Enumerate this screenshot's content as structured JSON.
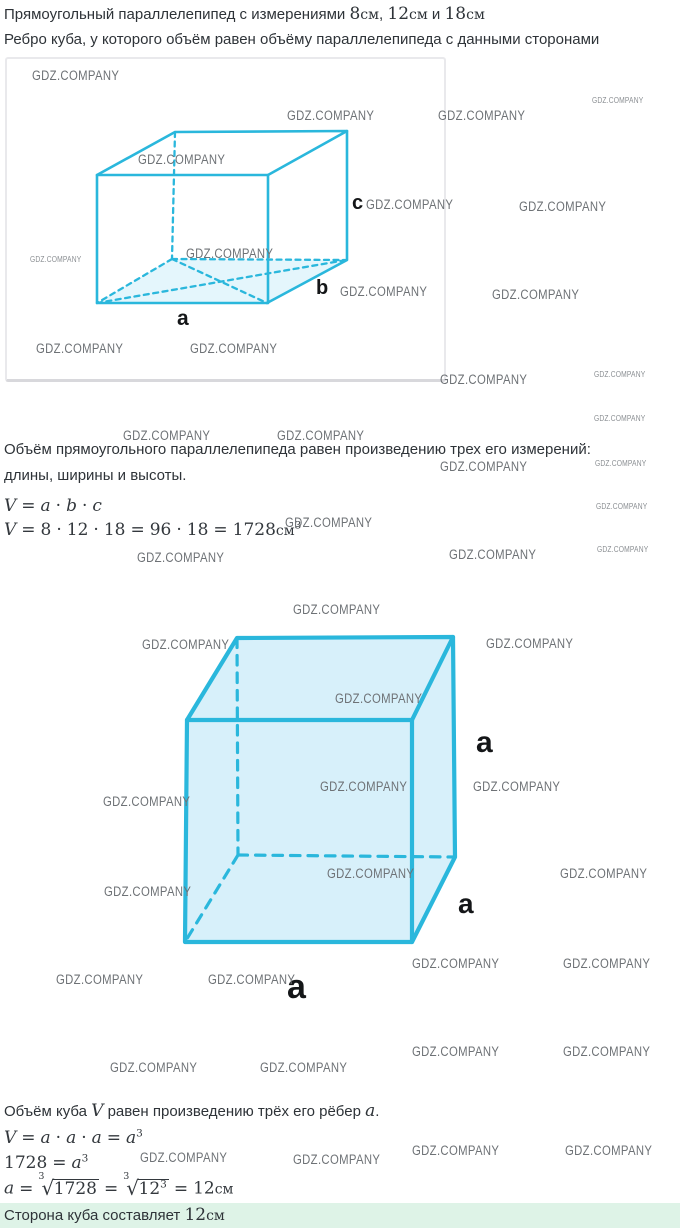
{
  "colors": {
    "accent_cyan": "#2ab7dc",
    "cube_fill": "#d7f0fa",
    "base_tint": "#e4f6fc",
    "text_dark": "#2e3338",
    "watermark_gray": "#6e7276",
    "answer_bg": "#def3e7"
  },
  "header": {
    "line1": [
      {
        "k": "t",
        "t": "Прямоугольный параллелепипед с измерениями "
      },
      {
        "k": "n",
        "t": "8"
      },
      {
        "k": "u",
        "t": "см"
      },
      {
        "k": "t",
        "t": ", "
      },
      {
        "k": "n",
        "t": "12"
      },
      {
        "k": "u",
        "t": "см"
      },
      {
        "k": "t",
        "t": " и "
      },
      {
        "k": "n",
        "t": "18"
      },
      {
        "k": "u",
        "t": "см"
      }
    ],
    "line2": "Ребро куба, у которого объём равен объёму параллелепипеда с данными сторонами"
  },
  "watermark": {
    "text": "GDZ.COMPANY",
    "items": [
      {
        "x": 32,
        "y": 68,
        "s": "r"
      },
      {
        "x": 287,
        "y": 108,
        "s": "r"
      },
      {
        "x": 438,
        "y": 108,
        "s": "r"
      },
      {
        "x": 592,
        "y": 96,
        "s": "s"
      },
      {
        "x": 138,
        "y": 152,
        "s": "r"
      },
      {
        "x": 366,
        "y": 197,
        "s": "r"
      },
      {
        "x": 519,
        "y": 199,
        "s": "r"
      },
      {
        "x": 30,
        "y": 255,
        "s": "s"
      },
      {
        "x": 186,
        "y": 246,
        "s": "r"
      },
      {
        "x": 340,
        "y": 284,
        "s": "r"
      },
      {
        "x": 492,
        "y": 287,
        "s": "r"
      },
      {
        "x": 36,
        "y": 341,
        "s": "r"
      },
      {
        "x": 190,
        "y": 341,
        "s": "r"
      },
      {
        "x": 440,
        "y": 372,
        "s": "r"
      },
      {
        "x": 594,
        "y": 370,
        "s": "s"
      },
      {
        "x": 123,
        "y": 428,
        "s": "r"
      },
      {
        "x": 277,
        "y": 428,
        "s": "r"
      },
      {
        "x": 594,
        "y": 414,
        "s": "s"
      },
      {
        "x": 440,
        "y": 459,
        "s": "r"
      },
      {
        "x": 595,
        "y": 459,
        "s": "s"
      },
      {
        "x": 285,
        "y": 515,
        "s": "r"
      },
      {
        "x": 596,
        "y": 502,
        "s": "s"
      },
      {
        "x": 449,
        "y": 547,
        "s": "r"
      },
      {
        "x": 597,
        "y": 545,
        "s": "s"
      },
      {
        "x": 137,
        "y": 550,
        "s": "r"
      },
      {
        "x": 293,
        "y": 602,
        "s": "r"
      },
      {
        "x": 142,
        "y": 637,
        "s": "r"
      },
      {
        "x": 486,
        "y": 636,
        "s": "r"
      },
      {
        "x": 335,
        "y": 691,
        "s": "r"
      },
      {
        "x": 320,
        "y": 779,
        "s": "r"
      },
      {
        "x": 103,
        "y": 794,
        "s": "r"
      },
      {
        "x": 473,
        "y": 779,
        "s": "r"
      },
      {
        "x": 327,
        "y": 866,
        "s": "r"
      },
      {
        "x": 104,
        "y": 884,
        "s": "r"
      },
      {
        "x": 560,
        "y": 866,
        "s": "r"
      },
      {
        "x": 412,
        "y": 956,
        "s": "r"
      },
      {
        "x": 563,
        "y": 956,
        "s": "r"
      },
      {
        "x": 56,
        "y": 972,
        "s": "r"
      },
      {
        "x": 208,
        "y": 972,
        "s": "r"
      },
      {
        "x": 412,
        "y": 1044,
        "s": "r"
      },
      {
        "x": 563,
        "y": 1044,
        "s": "r"
      },
      {
        "x": 110,
        "y": 1060,
        "s": "r"
      },
      {
        "x": 260,
        "y": 1060,
        "s": "r"
      },
      {
        "x": 412,
        "y": 1143,
        "s": "r"
      },
      {
        "x": 565,
        "y": 1143,
        "s": "r"
      },
      {
        "x": 140,
        "y": 1150,
        "s": "r"
      },
      {
        "x": 293,
        "y": 1152,
        "s": "r"
      }
    ]
  },
  "figure1": {
    "labels": [
      {
        "t": "a",
        "x": 177,
        "y": 308,
        "fs": 21
      },
      {
        "t": "b",
        "x": 316,
        "y": 278,
        "fs": 20
      },
      {
        "t": "c",
        "x": 352,
        "y": 193,
        "fs": 20
      }
    ]
  },
  "figure2": {
    "labels": [
      {
        "t": "a",
        "x": 476,
        "y": 728,
        "fs": 30
      },
      {
        "t": "a",
        "x": 458,
        "y": 890,
        "fs": 28
      },
      {
        "t": "a",
        "x": 287,
        "y": 970,
        "fs": 34
      }
    ]
  },
  "body": {
    "para1_line1": "Объём прямоугольного параллелепипеда равен произведению трех его измерений:",
    "para1_line2": "длины, ширины и высоты.",
    "para2": [
      {
        "k": "t",
        "t": "Объём куба "
      },
      {
        "k": "v",
        "t": "V"
      },
      {
        "k": "t",
        "t": " равен произведению трёх его рёбер "
      },
      {
        "k": "v",
        "t": "a"
      },
      {
        "k": "t",
        "t": "."
      }
    ],
    "answer": [
      {
        "k": "t",
        "t": "Сторона куба составляет "
      },
      {
        "k": "n",
        "t": "12"
      },
      {
        "k": "u",
        "t": "см"
      }
    ]
  },
  "formulas": {
    "f1": [
      {
        "k": "v",
        "t": "V"
      },
      {
        "k": "o",
        "t": "="
      },
      {
        "k": "v",
        "t": "a"
      },
      {
        "k": "o",
        "t": "·"
      },
      {
        "k": "v",
        "t": "b"
      },
      {
        "k": "o",
        "t": "·"
      },
      {
        "k": "v",
        "t": "c"
      }
    ],
    "f2": [
      {
        "k": "v",
        "t": "V"
      },
      {
        "k": "o",
        "t": "="
      },
      {
        "k": "n",
        "t": "8"
      },
      {
        "k": "o",
        "t": "·"
      },
      {
        "k": "n",
        "t": "12"
      },
      {
        "k": "o",
        "t": "·"
      },
      {
        "k": "n",
        "t": "18"
      },
      {
        "k": "o",
        "t": "="
      },
      {
        "k": "n",
        "t": "96"
      },
      {
        "k": "o",
        "t": "·"
      },
      {
        "k": "n",
        "t": "18"
      },
      {
        "k": "o",
        "t": "="
      },
      {
        "k": "n",
        "t": "1728"
      },
      {
        "k": "u",
        "t": "см"
      },
      {
        "k": "sup",
        "t": "3"
      }
    ],
    "f3": [
      {
        "k": "v",
        "t": "V"
      },
      {
        "k": "o",
        "t": "="
      },
      {
        "k": "v",
        "t": "a"
      },
      {
        "k": "o",
        "t": "·"
      },
      {
        "k": "v",
        "t": "a"
      },
      {
        "k": "o",
        "t": "·"
      },
      {
        "k": "v",
        "t": "a"
      },
      {
        "k": "o",
        "t": "="
      },
      {
        "k": "v",
        "t": "a"
      },
      {
        "k": "sup",
        "t": "3"
      }
    ],
    "f4": [
      {
        "k": "n",
        "t": "1728"
      },
      {
        "k": "o",
        "t": "="
      },
      {
        "k": "v",
        "t": "a"
      },
      {
        "k": "sup",
        "t": "3"
      }
    ],
    "f5": [
      {
        "k": "v",
        "t": "a"
      },
      {
        "k": "o",
        "t": "="
      },
      {
        "k": "root",
        "idx": "3",
        "body": [
          {
            "k": "n",
            "t": "1728"
          }
        ]
      },
      {
        "k": "o",
        "t": "="
      },
      {
        "k": "root",
        "idx": "3",
        "body": [
          {
            "k": "n",
            "t": "12"
          },
          {
            "k": "sup",
            "t": "3"
          }
        ]
      },
      {
        "k": "o",
        "t": "="
      },
      {
        "k": "n",
        "t": "12"
      },
      {
        "k": "u",
        "t": "см"
      }
    ]
  }
}
